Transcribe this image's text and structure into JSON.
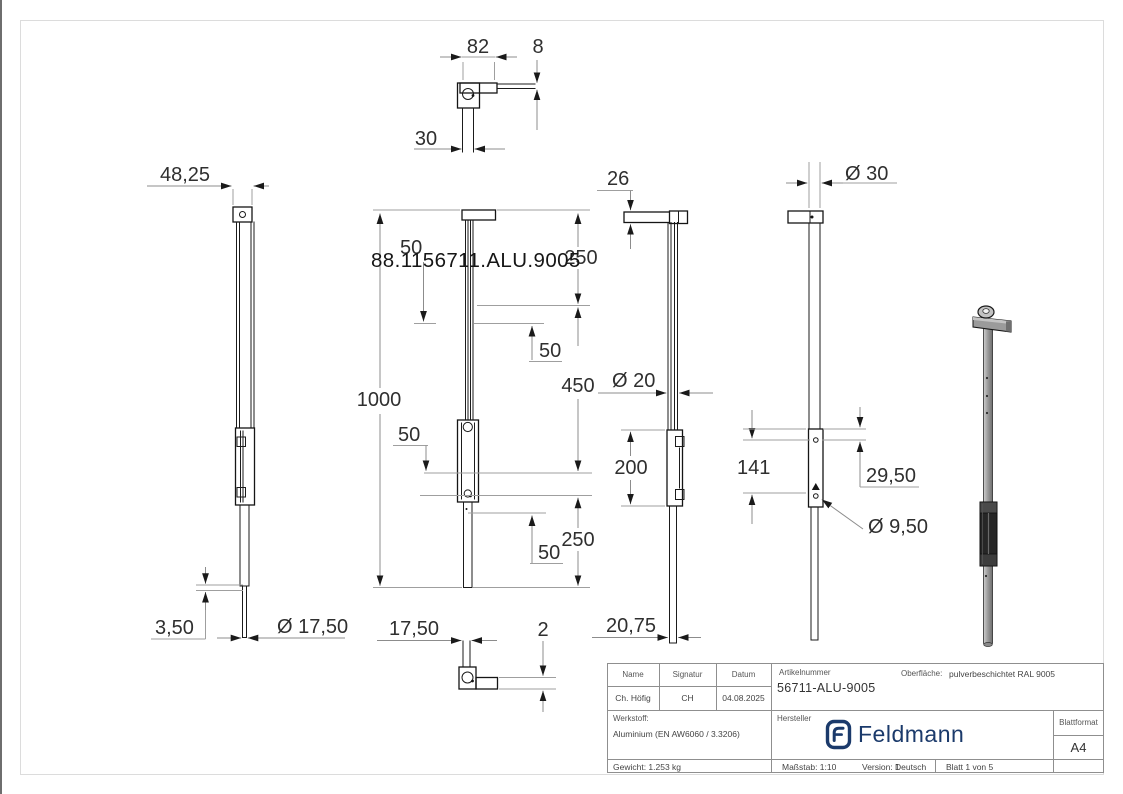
{
  "page": {
    "background": "#ffffff",
    "frame_color": "#dcdcdc"
  },
  "drawing": {
    "watermark": "88.1156711.ALU.9005",
    "dims": {
      "top_width": "82",
      "top_thickness": "8",
      "top_tube": "30",
      "left_head_width": "48,25",
      "left_wall": "3,50",
      "left_rod_dia": "Ø 17,50",
      "mid_250_top": "250",
      "mid_50_hidden": "50",
      "mid_1000": "1000",
      "mid_50_upper": "50",
      "mid_450": "450",
      "mid_50_left": "50",
      "mid_250_bottom": "250",
      "mid_50_lower": "50",
      "bottom_width": "17,50",
      "bottom_thickness": "2",
      "rmid_cap": "26",
      "rmid_dia": "Ø 20",
      "rmid_travel": "200",
      "rmid_bottom": "20,75",
      "right_cap_dia": "Ø 30",
      "right_span": "141",
      "right_offset": "29,50",
      "right_hole_dia": "Ø 9,50"
    }
  },
  "title_block": {
    "name_label": "Name",
    "signatur_label": "Signatur",
    "datum_label": "Datum",
    "name_value": "Ch. Höfig",
    "signatur_value": "CH",
    "datum_value": "04.08.2025",
    "werkstoff_label": "Werkstoff:",
    "werkstoff_value": "Aluminium (EN AW6060 / 3.3206)",
    "gewicht": "Gewicht: 1.253 kg",
    "artikelnummer_label": "Artikelnummer",
    "artikelnummer_value": "56711-ALU-9005",
    "oberflaeche_label": "Oberfläche:",
    "oberflaeche_value": "pulverbeschichtet RAL 9005",
    "hersteller_label": "Hersteller",
    "brand_name": "Feldmann",
    "brand_color": "#1b3a6b",
    "blattformat_label": "Blattformat",
    "blattformat_value": "A4",
    "massstab": "Maßstab: 1:10",
    "version": "Version: 1",
    "sprache": "Deutsch",
    "blatt": "Blatt 1 von 5"
  }
}
